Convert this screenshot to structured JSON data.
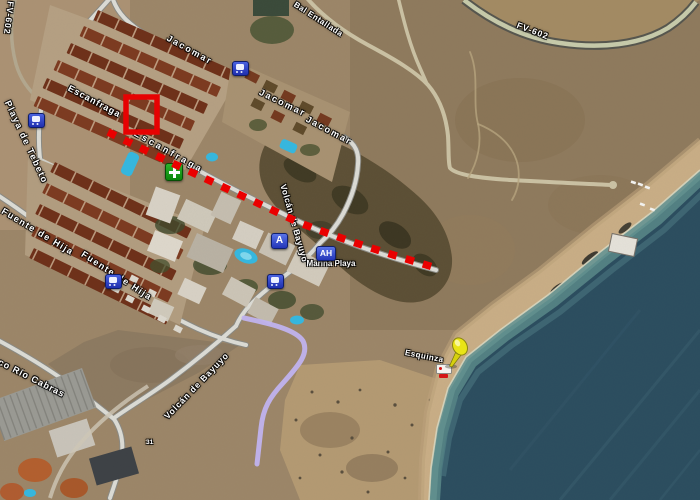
{
  "map_type": "satellite",
  "colors": {
    "annotation_red": "#e60202",
    "route_purple": "#c0b2ee",
    "pushpin_yellow": "#e9e416",
    "ocean_deep": "#2b4d5f",
    "road_fv602_fill": "#c7cbab",
    "poi_badge_blue": "#2336b8",
    "pharmacy_green": "#0a860a"
  },
  "road_labels": {
    "fv602_left": "FV-602",
    "fv602_right": "FV-602",
    "jacomar_1": "Jacomar",
    "jacomar_2": "Jacomar",
    "jacomar_3": "Jacomar",
    "entallada": "Bal Entallada",
    "escanfraga_1": "Escanfraga",
    "escanfraga_2": "Escanfraga",
    "playa_de_tebeto": "Playa de Tebeto",
    "fuente_de_hija_1": "Fuente de Hija",
    "fuente_de_hija_2": "Fuente de Hija",
    "volcan_de_bayuyo_1": "Volcán de Bayuyo",
    "volcan_de_bayuyo_2": "Volcán de Bayuyo",
    "barranco_rio_cabras": "Barranco Río Cabras",
    "house_number": "31"
  },
  "place_labels": {
    "beach": "Esquinza",
    "aparthotel_name": "Marina Playa"
  },
  "poi_badges": {
    "hotel_a": "A",
    "aparthotel_ah": "AH"
  },
  "icons": {
    "bus_stop": "bus-stop-icon",
    "pharmacy": "pharmacy-cross-icon",
    "pushpin": "map-pushpin-icon",
    "beach_marker": "beach-marker-icon"
  }
}
